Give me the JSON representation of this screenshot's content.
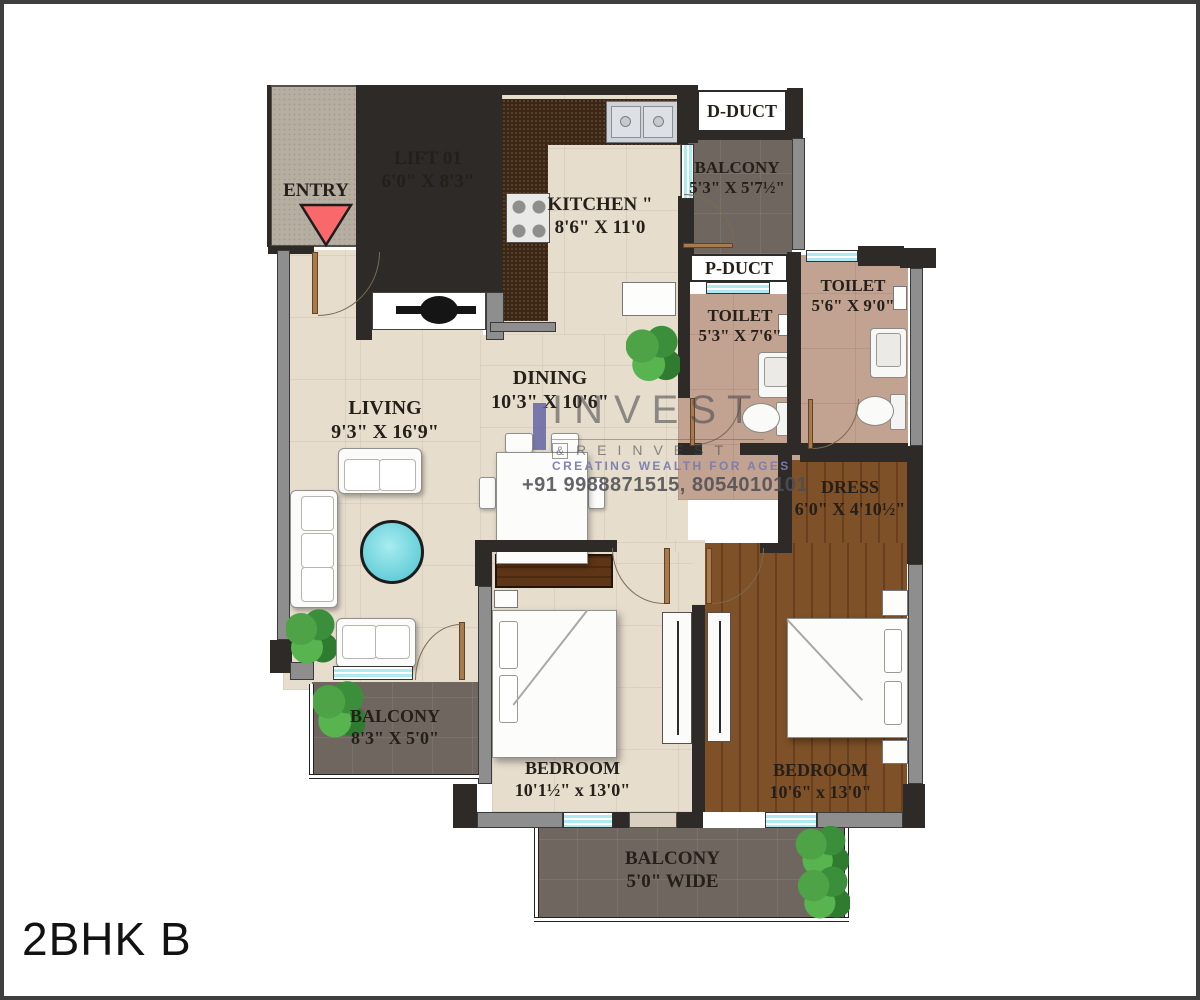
{
  "title": "2BHK B",
  "watermark": {
    "brand_top": "INVEST",
    "amp": "&",
    "brand_bottom": "REINVEST",
    "tagline": "CREATING WEALTH FOR AGES",
    "phone": "+91 9988871515, 8054010101"
  },
  "rooms": {
    "entry": {
      "label": "ENTRY"
    },
    "lift": {
      "label": "LIFT 01",
      "dim": "6'0\" X 8'3\""
    },
    "kitchen": {
      "label": "KITCHEN \"",
      "dim": "8'6\" X 11'0"
    },
    "d_duct": {
      "label": "D-DUCT"
    },
    "p_duct": {
      "label": "P-DUCT"
    },
    "balcony_top": {
      "label": "BALCONY",
      "dim": "5'3\" X 5'7½\""
    },
    "toilet_small": {
      "label": "TOILET",
      "dim": "5'3\" X 7'6\""
    },
    "toilet_big": {
      "label": "TOILET",
      "dim": "5'6\" X 9'0\""
    },
    "dress": {
      "label": "DRESS",
      "dim": "6'0\" X 4'10½\""
    },
    "living": {
      "label": "LIVING",
      "dim": "9'3\" X 16'9\""
    },
    "dining": {
      "label": "DINING",
      "dim": "10'3\" X 10'6\""
    },
    "bedroom_1": {
      "label": "BEDROOM",
      "dim": "10'1½\" x 13'0\""
    },
    "bedroom_2": {
      "label": "BEDROOM",
      "dim": "10'6\" x 13'0\""
    },
    "balcony_left": {
      "label": "BALCONY",
      "dim": "8'3\" X 5'0\""
    },
    "balcony_bottom": {
      "label": "BALCONY",
      "dim": "5'0\" WIDE"
    }
  },
  "colors": {
    "wall_dark": "#2d2a27",
    "wall_gray": "#8e8e8e",
    "floor_beige": "#e6ddcd",
    "floor_balcony": "#6f675f",
    "floor_toilet": "#c2a392",
    "floor_wood": "#7e5128",
    "counter_brown": "#3c2614",
    "window_cyan": "#aeeaf0",
    "entry_arrow_red": "#f9696b",
    "watermark_purple": "#5b5ea0",
    "table_cyan": "#64cdd8"
  }
}
